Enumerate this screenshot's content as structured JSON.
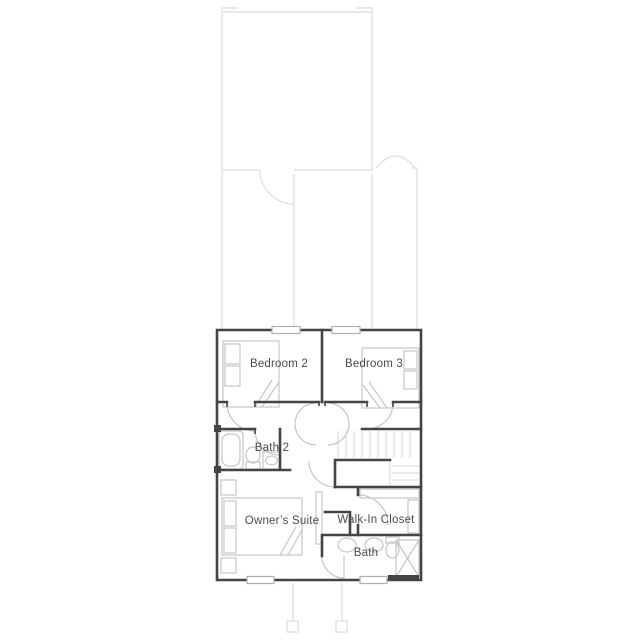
{
  "floor_plan": {
    "rooms": [
      {
        "name": "bedroom-2",
        "label": "Bedroom 2"
      },
      {
        "name": "bedroom-3",
        "label": "Bedroom 3"
      },
      {
        "name": "bath-2",
        "label": "Bath 2"
      },
      {
        "name": "owners-suite",
        "label": "Owner’s Suite"
      },
      {
        "name": "walk-in-closet",
        "label": "Walk-In Closet"
      },
      {
        "name": "bath",
        "label": "Bath"
      }
    ],
    "fixtures": [
      "bed",
      "pillows",
      "bathtub",
      "toilet",
      "sink-vanity",
      "stairs",
      "shower",
      "double-sink-vanity",
      "closet-shelving",
      "nightstands",
      "door-swing-arcs",
      "windows",
      "porch-posts"
    ],
    "colors": {
      "wall": "#444444",
      "fixture": "#c6c6c6",
      "ghost_outline": "#e2e2e2",
      "stair_tread": "#d9d9d9",
      "window_frame": "#b0b0b0",
      "label_text": "#4b4b4b",
      "background": "#ffffff"
    }
  }
}
